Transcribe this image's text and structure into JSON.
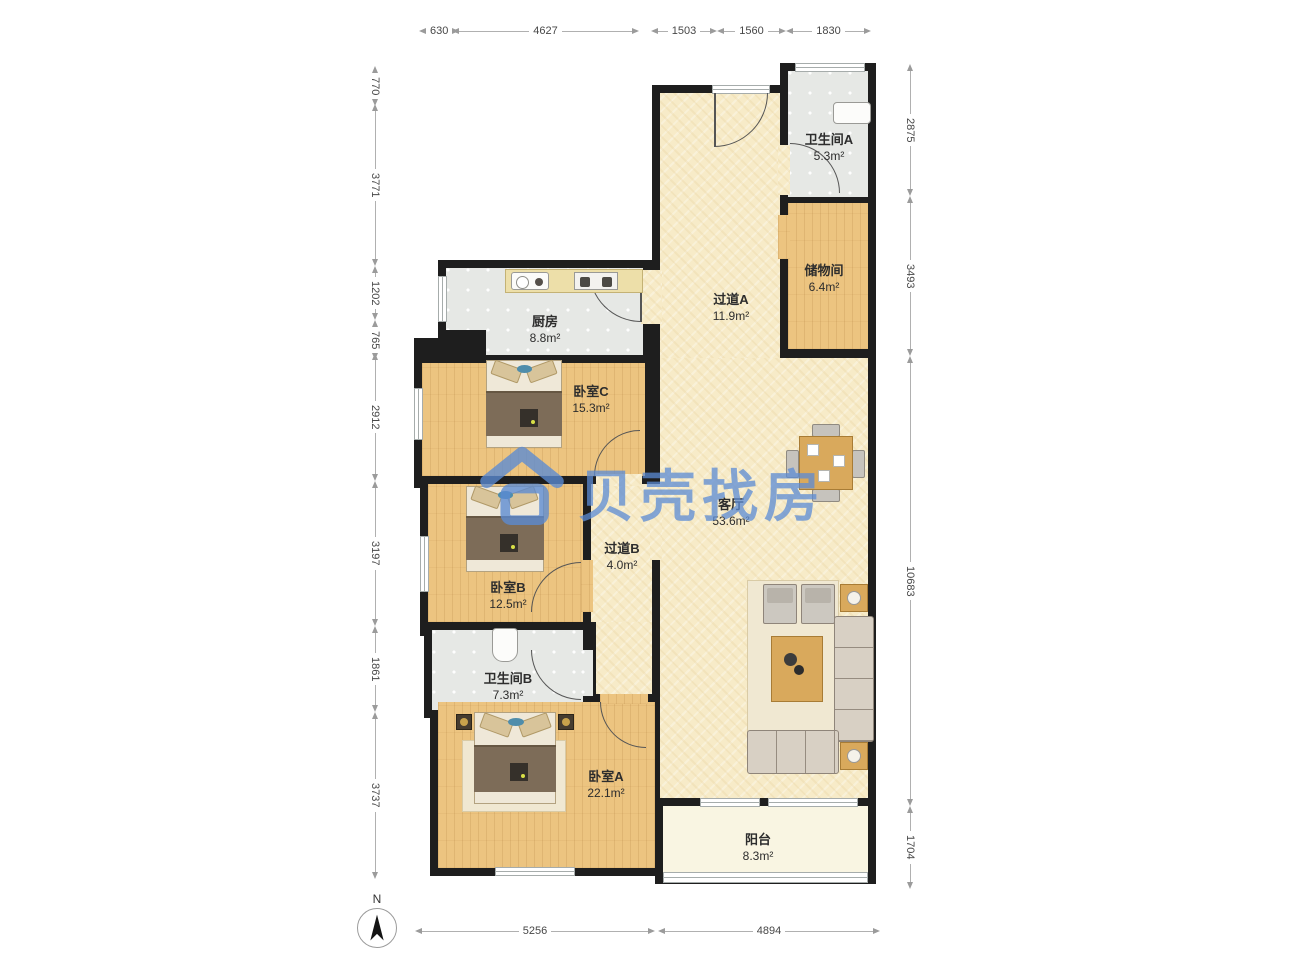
{
  "plan_title": "residential floor plan",
  "watermark": {
    "text": "贝壳找房",
    "color": "#5b8bd4"
  },
  "compass": {
    "label": "N"
  },
  "rooms": [
    {
      "id": "bathroom-a",
      "name": "卫生间A",
      "area": "5.3m²"
    },
    {
      "id": "storage",
      "name": "储物间",
      "area": "6.4m²"
    },
    {
      "id": "hallway-a",
      "name": "过道A",
      "area": "11.9m²"
    },
    {
      "id": "kitchen",
      "name": "厨房",
      "area": "8.8m²"
    },
    {
      "id": "bedroom-c",
      "name": "卧室C",
      "area": "15.3m²"
    },
    {
      "id": "living-room",
      "name": "客厅",
      "area": "53.6m²"
    },
    {
      "id": "hallway-b",
      "name": "过道B",
      "area": "4.0m²"
    },
    {
      "id": "bedroom-b",
      "name": "卧室B",
      "area": "12.5m²"
    },
    {
      "id": "bathroom-b",
      "name": "卫生间B",
      "area": "7.3m²"
    },
    {
      "id": "bedroom-a",
      "name": "卧室A",
      "area": "22.1m²"
    },
    {
      "id": "balcony",
      "name": "阳台",
      "area": "8.3m²"
    }
  ],
  "dims": {
    "top": [
      "630",
      "4627",
      "1503",
      "1560",
      "1830"
    ],
    "left": [
      "770",
      "3771",
      "1202",
      "765",
      "2912",
      "3197",
      "1861",
      "3737"
    ],
    "right": [
      "2875",
      "3493",
      "10683",
      "1704"
    ],
    "bottom": [
      "5256",
      "4894"
    ]
  },
  "colors": {
    "wall": "#1e1e1e",
    "wood_floor": "#ecc480",
    "tile_floor": "#e6e8e5",
    "hall_floor": "#f7ebc8",
    "balcony_floor": "#f9f5e2"
  }
}
